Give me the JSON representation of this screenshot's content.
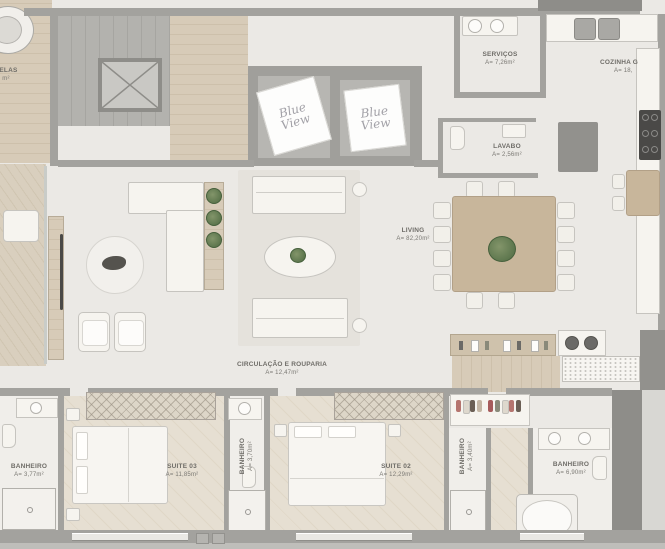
{
  "brand": {
    "logo_text": "Blue View"
  },
  "rooms": {
    "partial_left": {
      "name": "DELAS",
      "area": "m²"
    },
    "servicos": {
      "name": "SERVIÇOS",
      "area": "A= 7,26m²"
    },
    "cozinha": {
      "name": "COZINHA G",
      "area": "A= 18,"
    },
    "lavabo": {
      "name": "LAVABO",
      "area": "A= 2,56m²"
    },
    "living": {
      "name": "LIVING",
      "area": "A= 82,20m²"
    },
    "circulacao": {
      "name": "CIRCULAÇÃO E ROUPARIA",
      "area": "A= 12,47m²"
    },
    "banheiro_1": {
      "name": "BANHEIRO",
      "area": "A= 3,77m²"
    },
    "suite_03": {
      "name": "SUITE 03",
      "area": "A= 11,85m²"
    },
    "banheiro_2": {
      "name": "BANHEIRO",
      "area": "A= 3,70m²"
    },
    "suite_02": {
      "name": "SUITE 02",
      "area": "A= 12,29m²"
    },
    "banheiro_3": {
      "name": "BANHEIRO",
      "area": "A= 3,40m²"
    },
    "banheiro_4": {
      "name": "BANHEIRO",
      "area": "A= 6,90m²"
    }
  },
  "colors": {
    "wall": "#a3a29e",
    "wall_dark": "#8e8d89",
    "floor": "#ebe9e5",
    "wood": "#d7cbb8",
    "wood_table": "#c8b69b",
    "suite_floor": "#e6dfd2",
    "fixture_dark": "#4a4947",
    "plant_green": "#4e6a42",
    "label_text": "#6f6d68",
    "logo_text": "#a2a1a7"
  }
}
